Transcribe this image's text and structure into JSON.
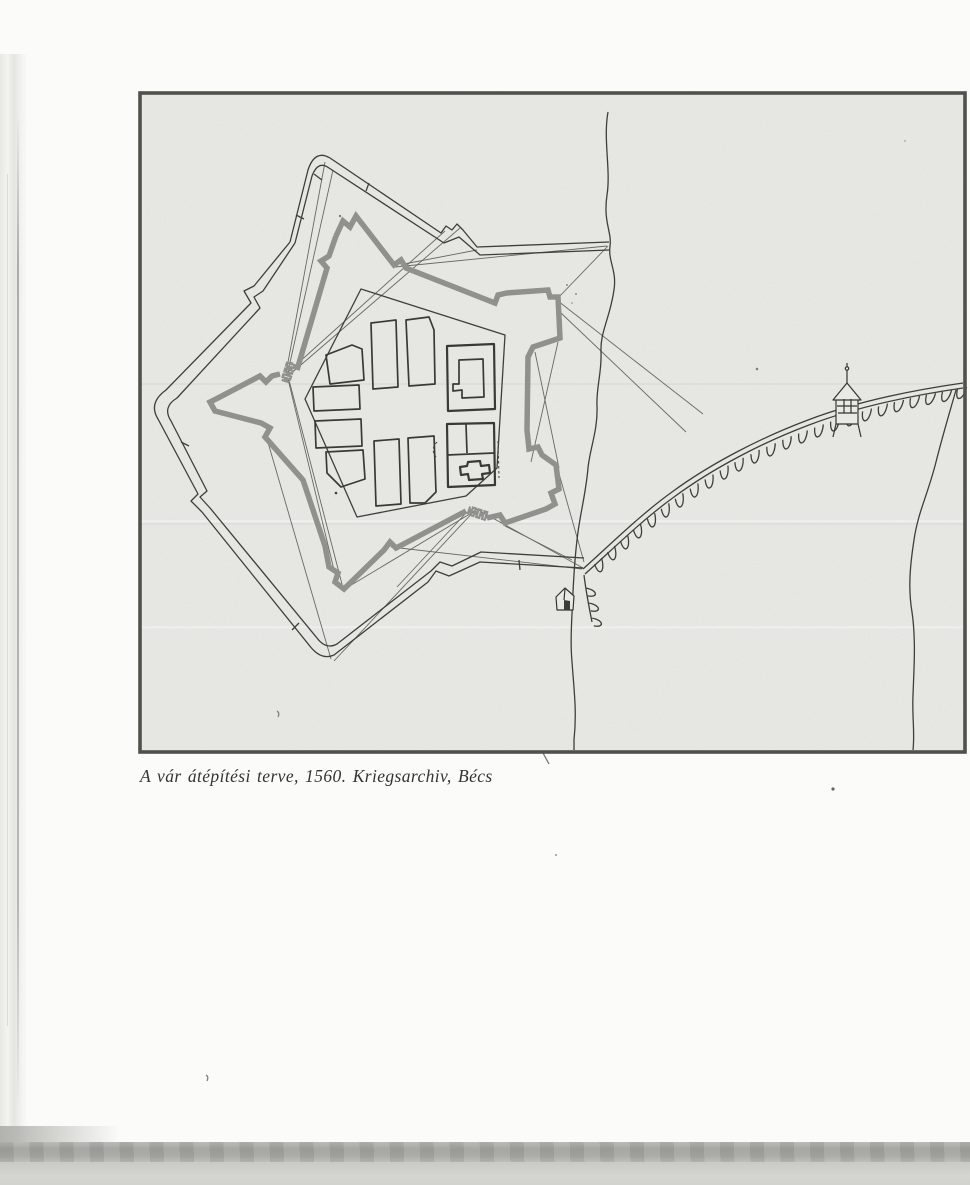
{
  "page": {
    "caption": "A vár átépítési terve, 1560. Kriegsarchiv, Bécs"
  },
  "figure": {
    "label": "fortress-reconstruction-plan-1560",
    "icons": {
      "watch_tower": "watch-tower-icon",
      "gate_house": "gate-house-icon",
      "west_gate": "castellated-gate-icon",
      "south_gate": "castellated-gate-icon"
    },
    "colors": {
      "page": "#fbfbf9",
      "paper": "#e9e9e6",
      "frame": "#50504c",
      "ink": "#3e3e3a",
      "rampart": "#90908c",
      "band": "#a5a5a1"
    }
  }
}
